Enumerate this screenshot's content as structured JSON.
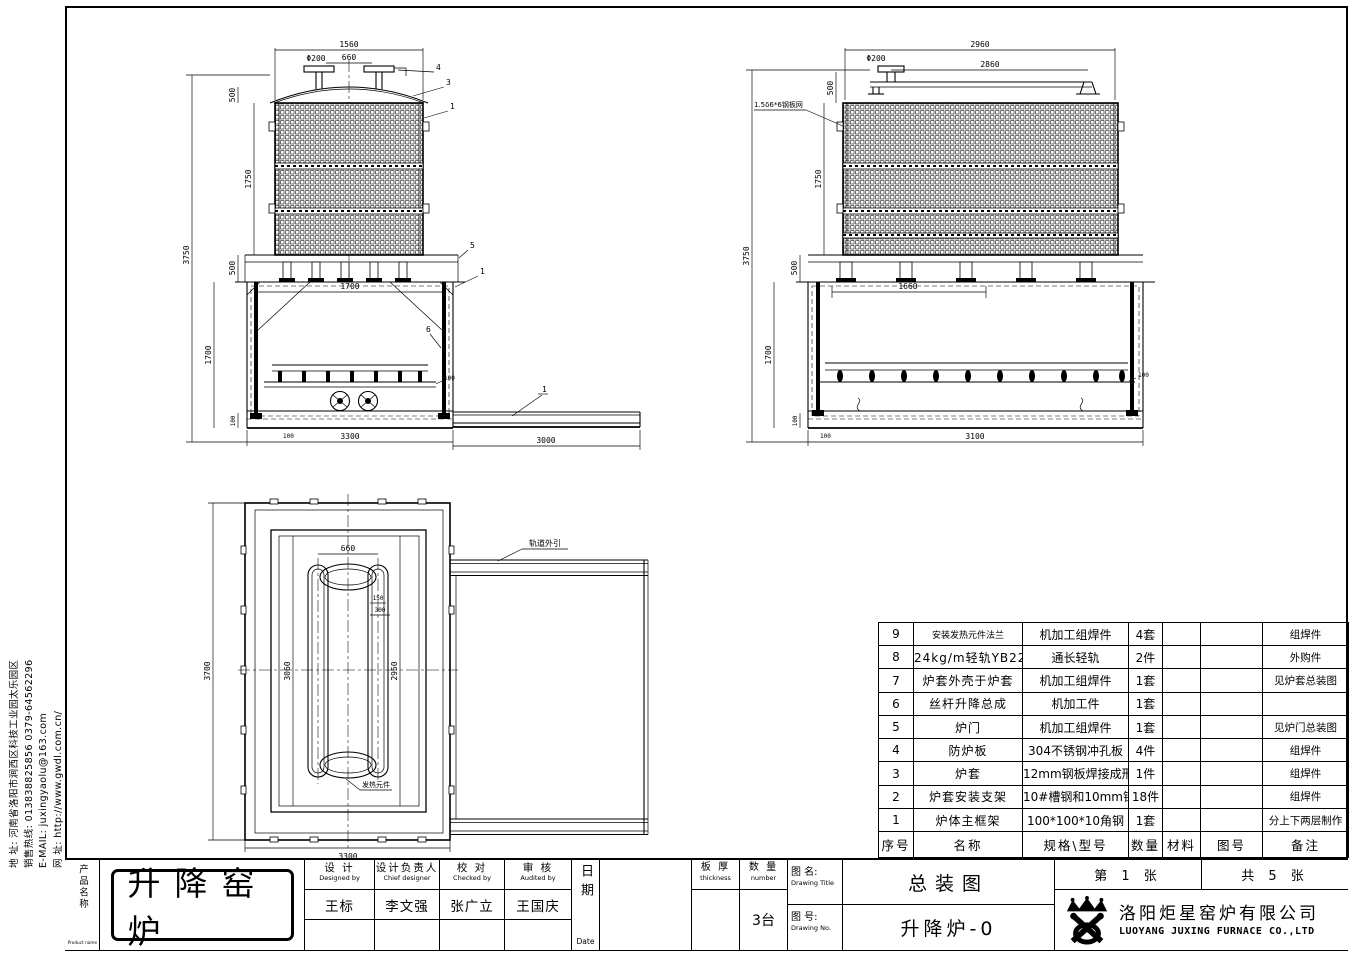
{
  "sidebar": {
    "line1": "地  址: 河南省洛阳市涧西区科技工业园太乐园区",
    "line2": "销售热线: 013838825856    0379-64562296",
    "line3": "E-MAIL:  juxingyaolu@163.com",
    "line4": "网  址: http://www.gwdl.com.cn/"
  },
  "views": {
    "front": {
      "dims": {
        "top_width": "1560",
        "flange_dia": "Φ200",
        "flange_span": "660",
        "dome_h": "500",
        "mesh_h": "1750",
        "total_h": "3750",
        "shelf_h": "500",
        "door_h": "1700",
        "inner_w": "1700",
        "base_h": "100",
        "tray_offset": "100",
        "pad_h": "100",
        "bottom_w": "3300",
        "rail_len": "3000"
      },
      "callouts": {
        "flange": "4",
        "dome": "3",
        "shell": "1",
        "shelf": "5",
        "frame": "1",
        "door": "6",
        "rail": "1"
      }
    },
    "side": {
      "dims": {
        "top_width": "2960",
        "rail_span": "2860",
        "flange_dia": "Φ200",
        "dome_h": "500",
        "mesh_h": "1750",
        "total_h": "3750",
        "shelf_h": "500",
        "door_h": "1700",
        "inner_w": "1660",
        "base_h": "100",
        "tray_offset": "100",
        "pad_h": "100",
        "bottom_w": "3100"
      },
      "mesh_label": "1.5δ6*6钢板网"
    },
    "plan": {
      "dims": {
        "flange_span": "660",
        "slot_w": "150",
        "slot_pitch": "300",
        "inner_h": "3060",
        "cavity_h": "2950",
        "total_h": "3700",
        "bottom_w": "3300"
      },
      "rail_label": "轨道外引",
      "element_label": "发热元件"
    }
  },
  "parts_table": {
    "headers": [
      "序号",
      "名称",
      "规格\\型号",
      "数量",
      "材料",
      "图号",
      "备注"
    ],
    "rows": [
      [
        "9",
        "安装发热元件法兰",
        "机加工组焊件",
        "4套",
        "",
        "",
        "组焊件"
      ],
      [
        "8",
        "24kg/m轻轨YB222-63",
        "通长轻轨",
        "2件",
        "",
        "",
        "外购件"
      ],
      [
        "7",
        "炉套外壳于炉套",
        "机加工组焊件",
        "1套",
        "",
        "",
        "见炉套总装图"
      ],
      [
        "6",
        "丝杆升降总成",
        "机加工件",
        "1套",
        "",
        "",
        ""
      ],
      [
        "5",
        "炉门",
        "机加工组焊件",
        "1套",
        "",
        "",
        "见炉门总装图"
      ],
      [
        "4",
        "防炉板",
        "304不锈钢冲孔板",
        "4件",
        "",
        "",
        "组焊件"
      ],
      [
        "3",
        "炉套",
        "12mm钢板焊接成形",
        "1件",
        "",
        "",
        "组焊件"
      ],
      [
        "2",
        "炉套安装支架",
        "10#槽钢和10mm钢板",
        "18件",
        "",
        "",
        "组焊件"
      ],
      [
        "1",
        "炉体主框架",
        "100*100*10角钢",
        "1套",
        "",
        "",
        "分上下两层制作"
      ]
    ]
  },
  "title_block": {
    "product_label_cn": "产品名称",
    "product_label_en": "Product name",
    "product_name": "升降窑炉",
    "roles": [
      {
        "cn": "设  计",
        "en": "Designed by",
        "name": "王标"
      },
      {
        "cn": "设计负责人",
        "en": "Chief designer",
        "name": "李文强"
      },
      {
        "cn": "校  对",
        "en": "Checked by",
        "name": "张广立"
      },
      {
        "cn": "审  核",
        "en": "Audited by",
        "name": "王国庆"
      }
    ],
    "date_cn": "日期",
    "date_en": "Date",
    "thickness_cn": "板  厚",
    "thickness_en": "thickness",
    "qty_cn": "数  量",
    "qty_en": "number",
    "qty_value": "3台",
    "title_label_cn": "图 名:",
    "title_label_en": "Drawing Title",
    "title_value": "总装图",
    "no_label_cn": "图 号:",
    "no_label_en": "Drawing No.",
    "no_value": "升降炉-0",
    "sheet_no": "第  1  张",
    "sheet_total": "共  5  张",
    "company_cn": "洛阳炬星窑炉有限公司",
    "company_en": "LUOYANG JUXING FURNACE CO.,LTD"
  }
}
